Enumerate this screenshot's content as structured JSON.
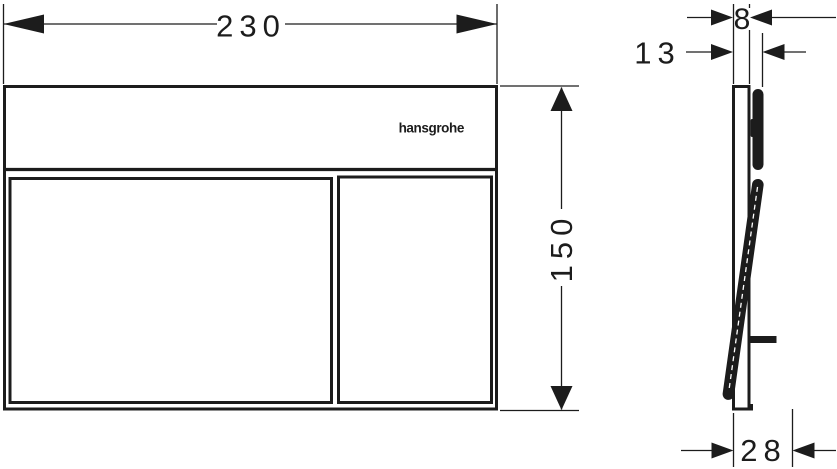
{
  "drawing": {
    "brand_logo": "hansgrohe",
    "dimensions": {
      "front_width": "230",
      "front_height": "150",
      "side_plate_depth": "8",
      "side_frame_depth": "13",
      "side_button_open_depth": "28"
    },
    "units": "mm",
    "colors": {
      "ink": "#1c1c1c",
      "paper": "#ffffff"
    }
  }
}
